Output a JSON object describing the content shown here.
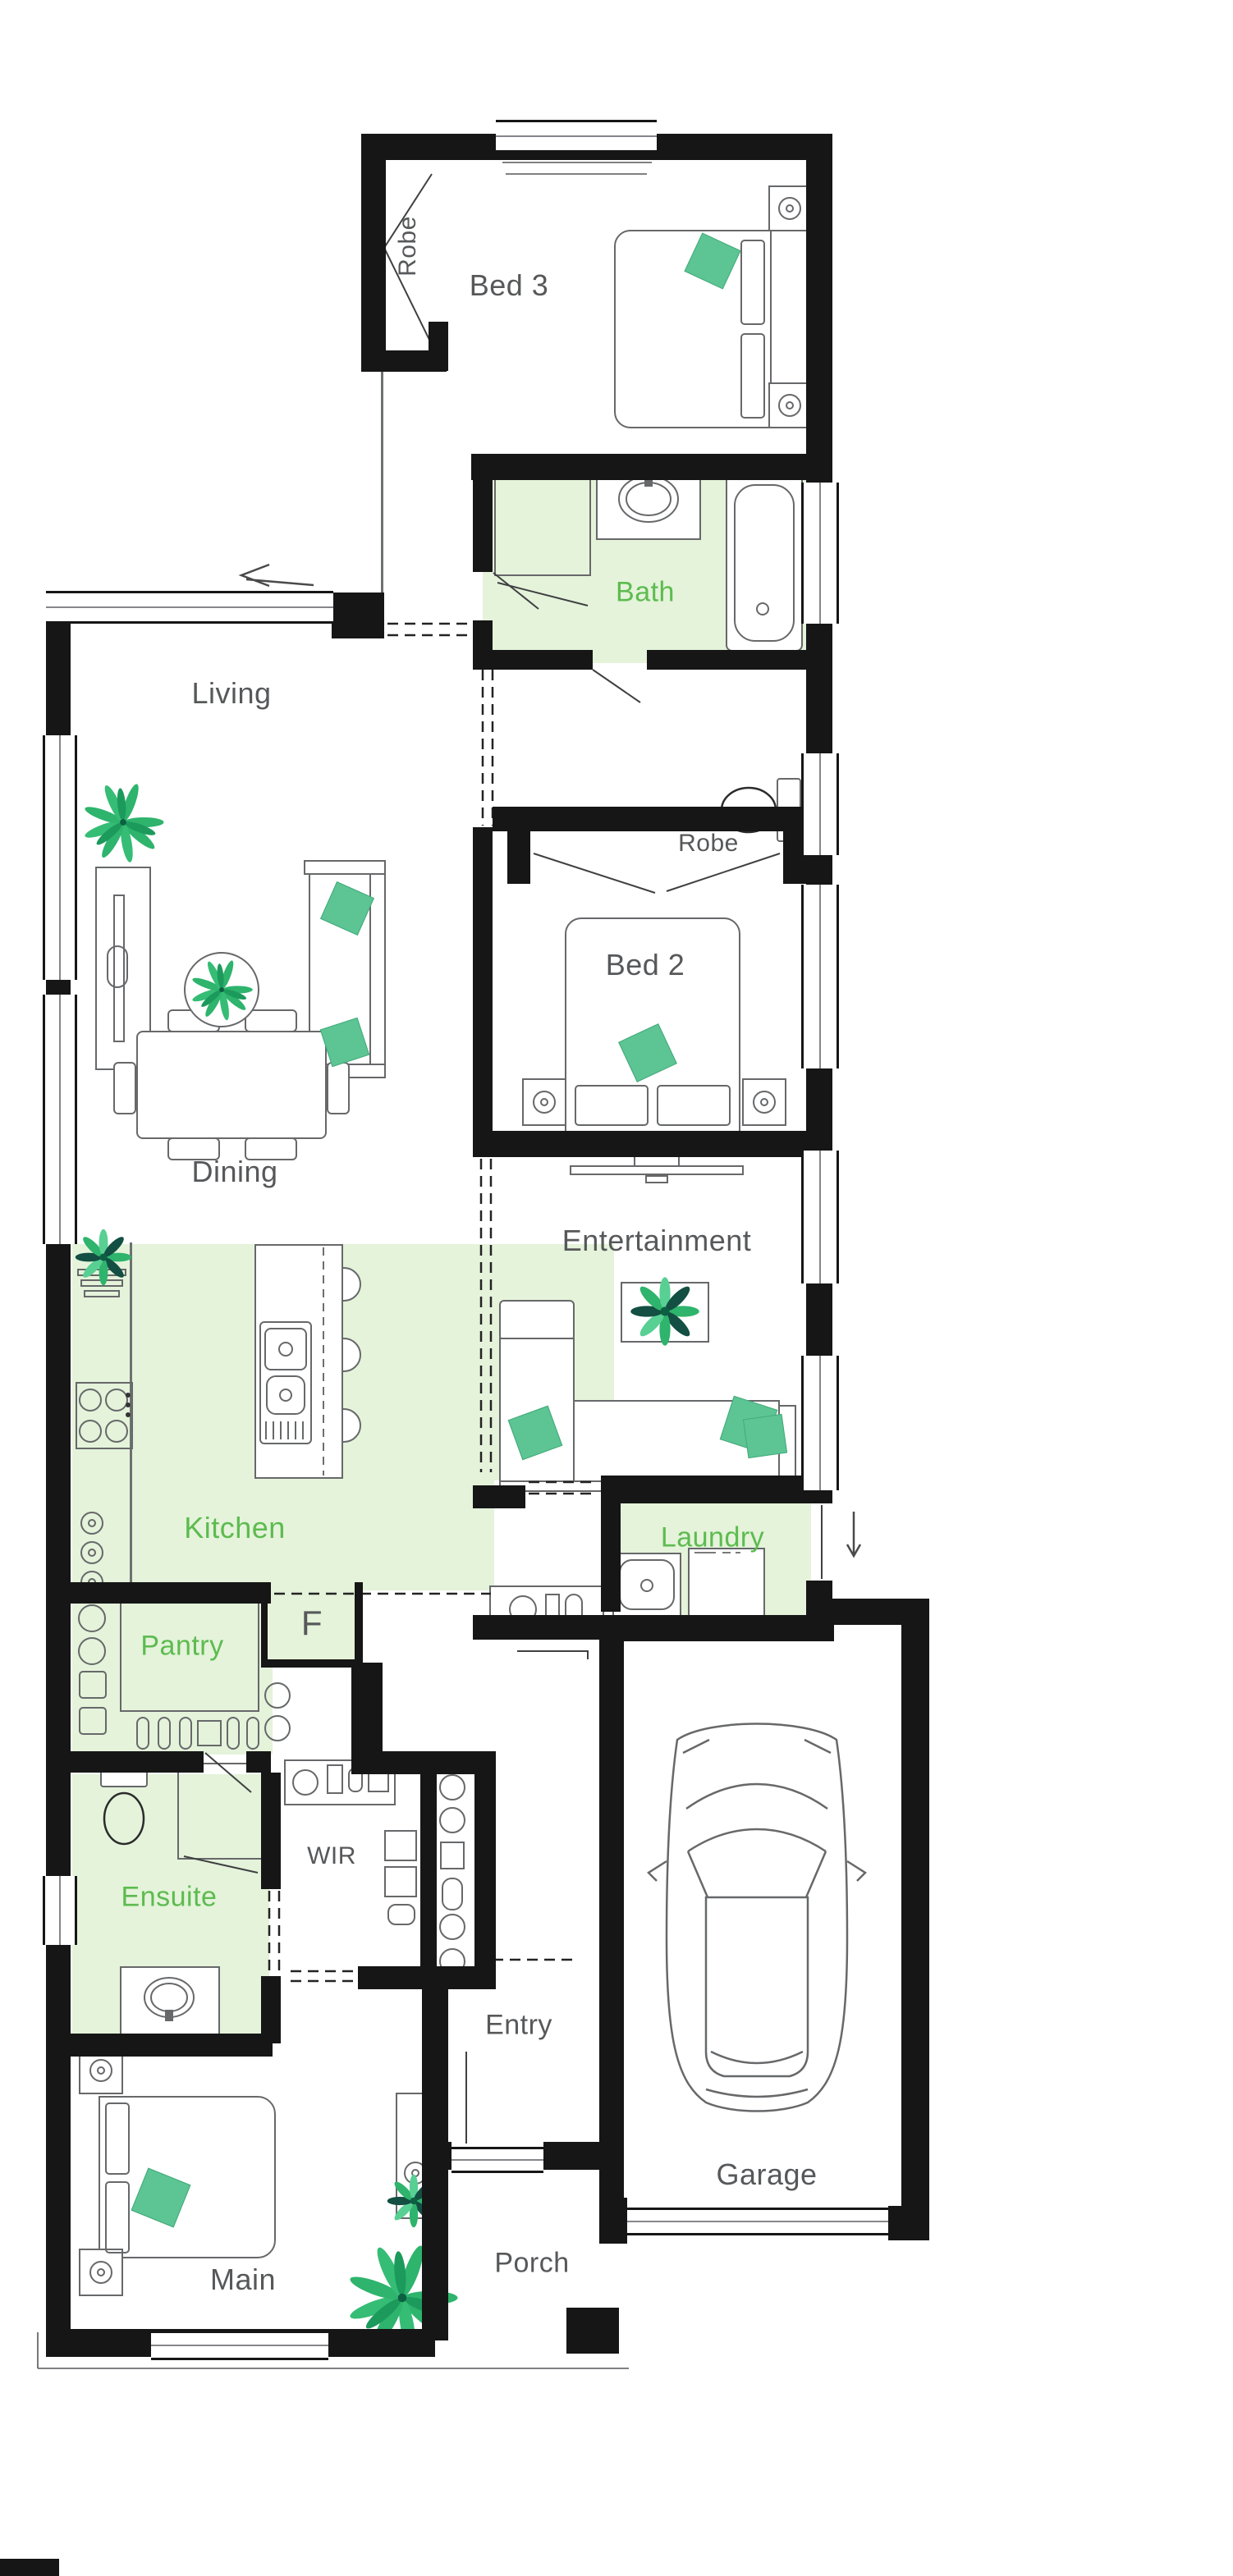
{
  "plan_type": "residential-floor-plan",
  "colors": {
    "wall": "#161616",
    "shaded_room_fill": "#e4f3da",
    "green_label": "#5dbb4f",
    "gray_label": "#57585a",
    "furniture_line": "#67686a",
    "accent_cushion": "#5cc593",
    "plant_green": "#2eb46c"
  },
  "rooms": [
    {
      "id": "bed3",
      "label": "Bed 3",
      "shaded": false
    },
    {
      "id": "robe-bed3",
      "label": "Robe",
      "shaded": false
    },
    {
      "id": "bath",
      "label": "Bath",
      "shaded": true
    },
    {
      "id": "living",
      "label": "Living",
      "shaded": false
    },
    {
      "id": "robe-bed2",
      "label": "Robe",
      "shaded": false
    },
    {
      "id": "bed2",
      "label": "Bed 2",
      "shaded": false
    },
    {
      "id": "entertainment",
      "label": "Entertainment",
      "shaded": false
    },
    {
      "id": "dining",
      "label": "Dining",
      "shaded": false
    },
    {
      "id": "kitchen",
      "label": "Kitchen",
      "shaded": true
    },
    {
      "id": "laundry",
      "label": "Laundry",
      "shaded": true
    },
    {
      "id": "pantry",
      "label": "Pantry",
      "shaded": true
    },
    {
      "id": "fridge",
      "label": "F",
      "shaded": false
    },
    {
      "id": "ensuite",
      "label": "Ensuite",
      "shaded": true
    },
    {
      "id": "wir",
      "label": "WIR",
      "shaded": false
    },
    {
      "id": "entry",
      "label": "Entry",
      "shaded": false
    },
    {
      "id": "garage",
      "label": "Garage",
      "shaded": false
    },
    {
      "id": "main",
      "label": "Main",
      "shaded": false
    },
    {
      "id": "porch",
      "label": "Porch",
      "shaded": false
    }
  ],
  "annotations": {
    "sliding_door_arrow_direction": "left",
    "external_step_arrow_direction": "down"
  },
  "fixtures": [
    "double-bed",
    "bedside-lamp-table",
    "wardrobe-sliding-door",
    "bathtub",
    "shower",
    "vanity-basin",
    "toilet",
    "dining-table-6-seats",
    "tv-cabinet",
    "wall-mounted-tv",
    "sofa",
    "chaise-sofa",
    "round-side-table",
    "coffee-table",
    "kitchen-island-with-sink",
    "cooktop",
    "bar-stool",
    "fridge-space",
    "laundry-tub",
    "washing-machine",
    "pantry-shelving",
    "linen-shelving",
    "dresser",
    "car",
    "potted-plant"
  ]
}
